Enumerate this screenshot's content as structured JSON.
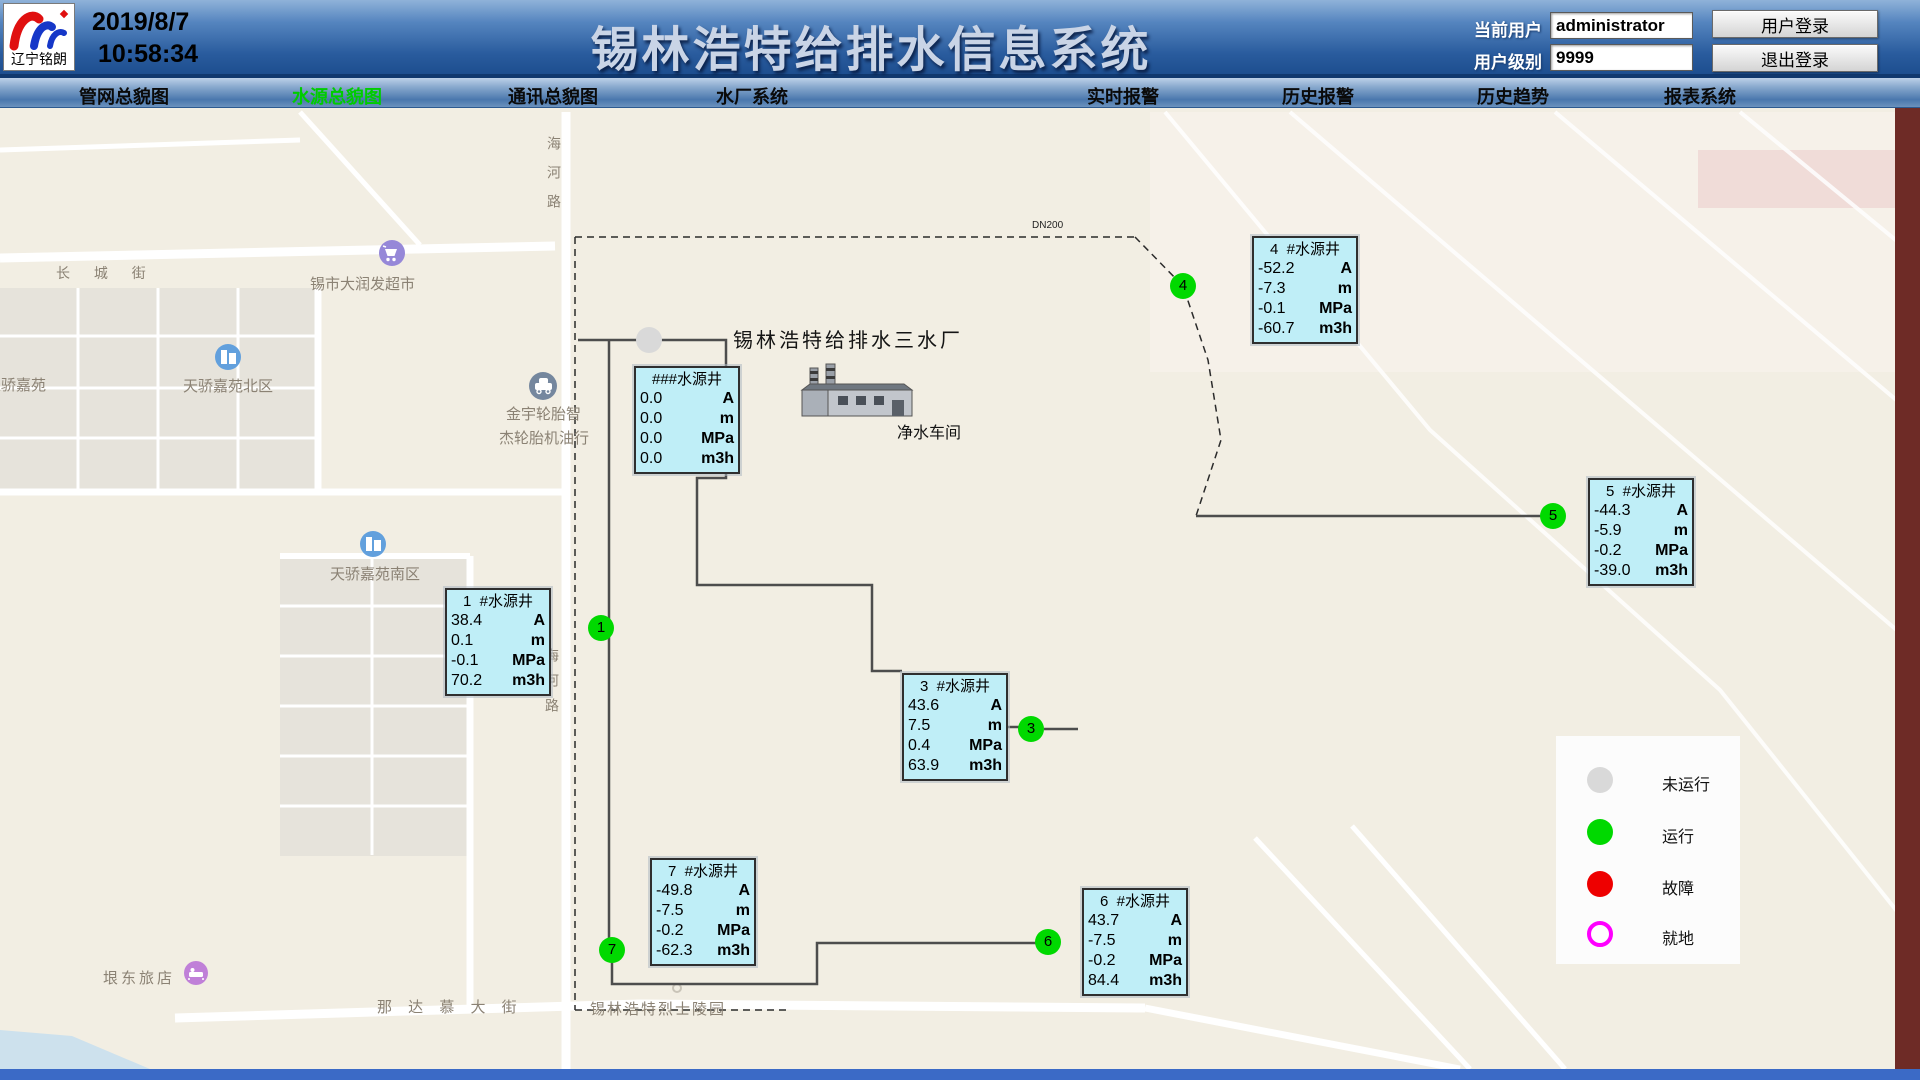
{
  "header": {
    "logo_text": "辽宁铭朗",
    "date": "2019/8/7",
    "time": "10:58:34",
    "title": "锡林浩特给排水信息系统",
    "current_user_label": "当前用户",
    "current_user_value": "administrator",
    "user_level_label": "用户级别",
    "user_level_value": "9999",
    "login_button": "用户登录",
    "logout_button": "退出登录"
  },
  "nav": {
    "items": [
      {
        "label": "管网总貌图",
        "active": false
      },
      {
        "label": "水源总貌图",
        "active": true
      },
      {
        "label": "通讯总貌图",
        "active": false
      },
      {
        "label": "水厂系统",
        "active": false
      },
      {
        "label": "实时报警",
        "active": false
      },
      {
        "label": "历史报警",
        "active": false
      },
      {
        "label": "历史趋势",
        "active": false
      },
      {
        "label": "报表系统",
        "active": false
      }
    ]
  },
  "plant": {
    "name": "锡林浩特给排水三水厂",
    "workshop": "净水车间",
    "pipe_label": "DN200"
  },
  "map_labels": {
    "changcheng": "长 城 街",
    "supermarket": "锡市大润发超市",
    "tianjiao": "天骄嘉苑",
    "tianjiao_north": "天骄嘉苑北区",
    "jinyu": "金宇轮胎智",
    "jielun": "杰轮胎机油行",
    "tianjiao_south": "天骄嘉苑南区",
    "haihe_top": "海河路",
    "haihe_bottom": "海河路",
    "nadamu": "那 达 慕 大 街",
    "martyrs": "锡林浩特烈士陵园",
    "hotel": "垠东旅店"
  },
  "wells": [
    {
      "id": "###",
      "title": "###水源井",
      "rows": [
        [
          "0.0",
          "A"
        ],
        [
          "0.0",
          "m"
        ],
        [
          "0.0",
          "MPa"
        ],
        [
          "0.0",
          "m3h"
        ]
      ]
    },
    {
      "id": "1",
      "title": "1  #水源井",
      "rows": [
        [
          "38.4",
          "A"
        ],
        [
          "0.1",
          "m"
        ],
        [
          "-0.1",
          "MPa"
        ],
        [
          "70.2",
          "m3h"
        ]
      ]
    },
    {
      "id": "3",
      "title": "3  #水源井",
      "rows": [
        [
          "43.6",
          "A"
        ],
        [
          "7.5",
          "m"
        ],
        [
          "0.4",
          "MPa"
        ],
        [
          "63.9",
          "m3h"
        ]
      ]
    },
    {
      "id": "4",
      "title": "4  #水源井",
      "rows": [
        [
          "-52.2",
          "A"
        ],
        [
          "-7.3",
          "m"
        ],
        [
          "-0.1",
          "MPa"
        ],
        [
          "-60.7",
          "m3h"
        ]
      ]
    },
    {
      "id": "5",
      "title": "5  #水源井",
      "rows": [
        [
          "-44.3",
          "A"
        ],
        [
          "-5.9",
          "m"
        ],
        [
          "-0.2",
          "MPa"
        ],
        [
          "-39.0",
          "m3h"
        ]
      ]
    },
    {
      "id": "6",
      "title": "6  #水源井",
      "rows": [
        [
          "43.7",
          "A"
        ],
        [
          "-7.5",
          "m"
        ],
        [
          "-0.2",
          "MPa"
        ],
        [
          "84.4",
          "m3h"
        ]
      ]
    },
    {
      "id": "7",
      "title": "7  #水源井",
      "rows": [
        [
          "-49.8",
          "A"
        ],
        [
          "-7.5",
          "m"
        ],
        [
          "-0.2",
          "MPa"
        ],
        [
          "-62.3",
          "m3h"
        ]
      ]
    }
  ],
  "circles": [
    {
      "number": "",
      "status": "not_running"
    },
    {
      "number": "1",
      "status": "running"
    },
    {
      "number": "3",
      "status": "running"
    },
    {
      "number": "4",
      "status": "running"
    },
    {
      "number": "5",
      "status": "running"
    },
    {
      "number": "6",
      "status": "running"
    },
    {
      "number": "7",
      "status": "running"
    }
  ],
  "legend": {
    "items": [
      {
        "label": "未运行",
        "status": "not_running",
        "color": "#d9d9d9",
        "style": "fill"
      },
      {
        "label": "运行",
        "status": "running",
        "color": "#00d900",
        "style": "fill"
      },
      {
        "label": "故障",
        "status": "fault",
        "color": "#ee0000",
        "style": "fill"
      },
      {
        "label": "就地",
        "status": "local",
        "color": "#ff00ff",
        "style": "ring"
      }
    ]
  },
  "colors": {
    "nav_active": "#00cc00",
    "well_box_bg": "#bfeef7",
    "header_blue": "#2a5c9e"
  }
}
